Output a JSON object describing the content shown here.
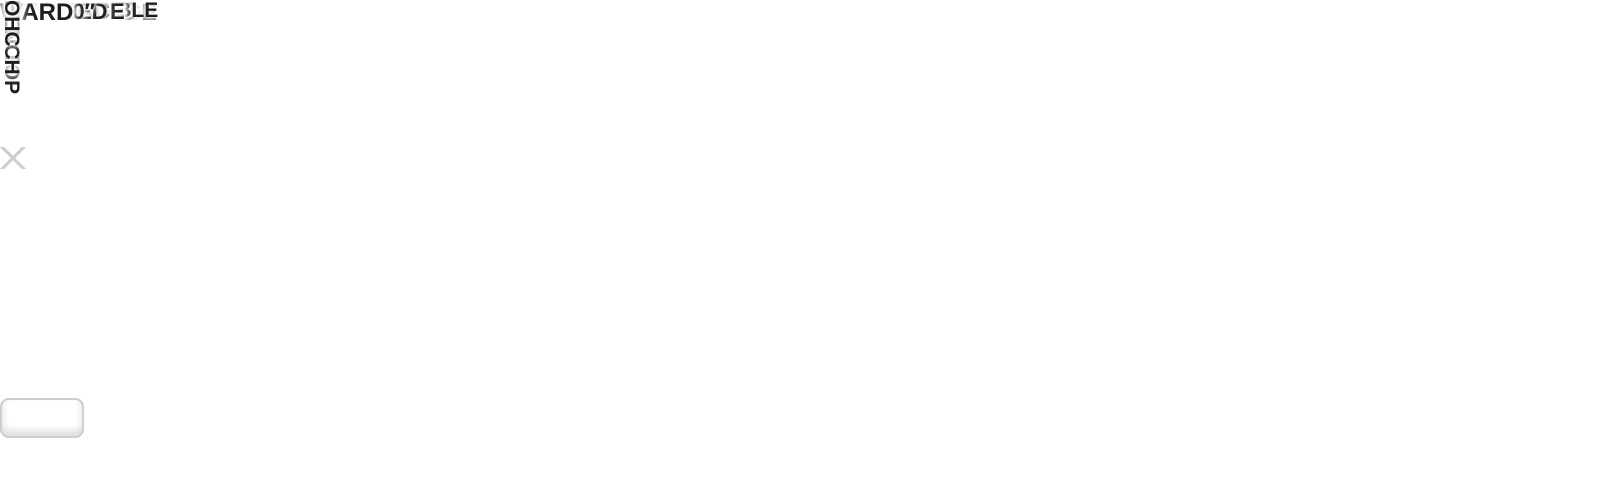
{
  "type": "rv-floorplan-diagram",
  "colors": {
    "background": "#ffffff",
    "wall_gray": "#64686b",
    "floor_wood": "#d7c5a1",
    "bath_floor": "#e5dbc4",
    "cabinet_tan": "#d6cbb2",
    "sofa": "#e6e4dc",
    "bed": "#e1d7bd",
    "bed_footer": "#49524b",
    "fireplace_orange": "#ff7a00",
    "tv_blue": "#2f77d6",
    "front_cap_silver": "#d9dbdc",
    "label_text": "#1f1d1e"
  },
  "labels": {
    "slide_tray_line1": "SLIDE",
    "slide_tray_line2": "TRAY",
    "kitchen_ohc_top_left": "OHC",
    "kitchen_micro": "MICRO",
    "kitchen_ohc_top_right": "OHC",
    "kitchen_ohc_side": "OHC",
    "bar_top": "BAR TOP",
    "fridge": "FRIDGE",
    "pantry": "PANTRY",
    "lounge": "92″L-LOUNGE",
    "ent_line1": "ENT.",
    "ent_line2": "CENTER/",
    "ent_line3": "FIREPLACE",
    "desk": "DESK",
    "hutch": "HUTCH",
    "table_chairs_line1": "TABLE",
    "table_chairs_line2": "&",
    "table_chairs_line3": "CHAIRS",
    "table_booth_line1": "TABLE",
    "table_booth_line2": "W/HALF",
    "table_booth_line3": "BOOTH",
    "awning_left": "19′ AWNING",
    "awning_right": "19′ AWNING",
    "bath_ohc": "OHC",
    "bath_bench": "BENCH",
    "linen": "LINEN",
    "closet": "CLOSET",
    "washer_line1": "WASHER/",
    "washer_line2": "DRYER PREP",
    "washer_line3": "W/REMOVABLE",
    "washer_line4": "SHELF",
    "wardrobe": "WARDROBE",
    "tv": "TV",
    "fireplace": "FIREPLACE",
    "king_bed_line1": "KING BED",
    "king_bed_line2": "72″ × 80″",
    "ward_top": "WARD",
    "ward_bottom": "WARD",
    "front_bench": "BENCH",
    "front_ohc": "OHC"
  }
}
